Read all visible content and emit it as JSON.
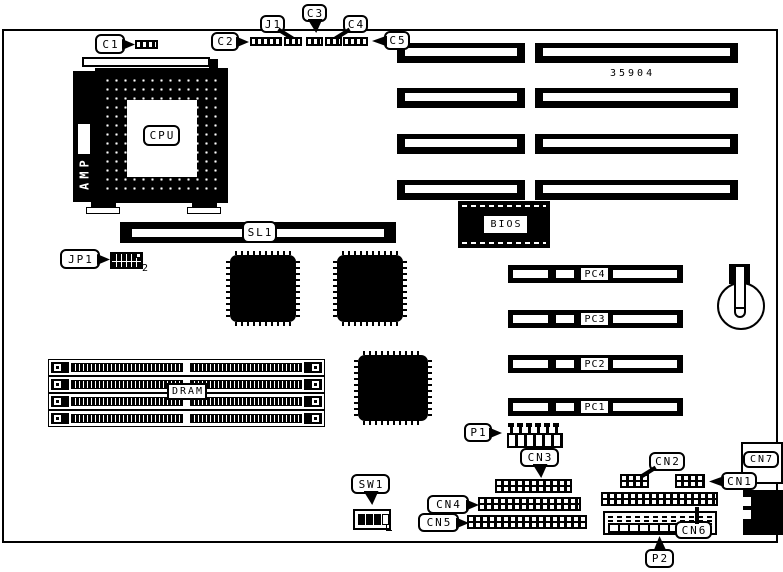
{
  "colors": {
    "ink": "#000000",
    "paper": "#ffffff"
  },
  "board": {
    "part_number": "35904"
  },
  "labels": {
    "c1": "C1",
    "c2": "C2",
    "c3": "C3",
    "c4": "C4",
    "c5": "C5",
    "j1": "J1",
    "jp1": "JP1",
    "jp1_pin": "2",
    "cpu": "CPU",
    "amp": "AMP",
    "sl1": "SL1",
    "bios": "BIOS",
    "dram": "DRAM",
    "sw1": "SW1",
    "pc1": "PC1",
    "pc2": "PC2",
    "pc3": "PC3",
    "pc4": "PC4",
    "p1": "P1",
    "p2": "P2",
    "cn1": "CN1",
    "cn2": "CN2",
    "cn3": "CN3",
    "cn4": "CN4",
    "cn5": "CN5",
    "cn6": "CN6",
    "cn7": "CN7"
  }
}
